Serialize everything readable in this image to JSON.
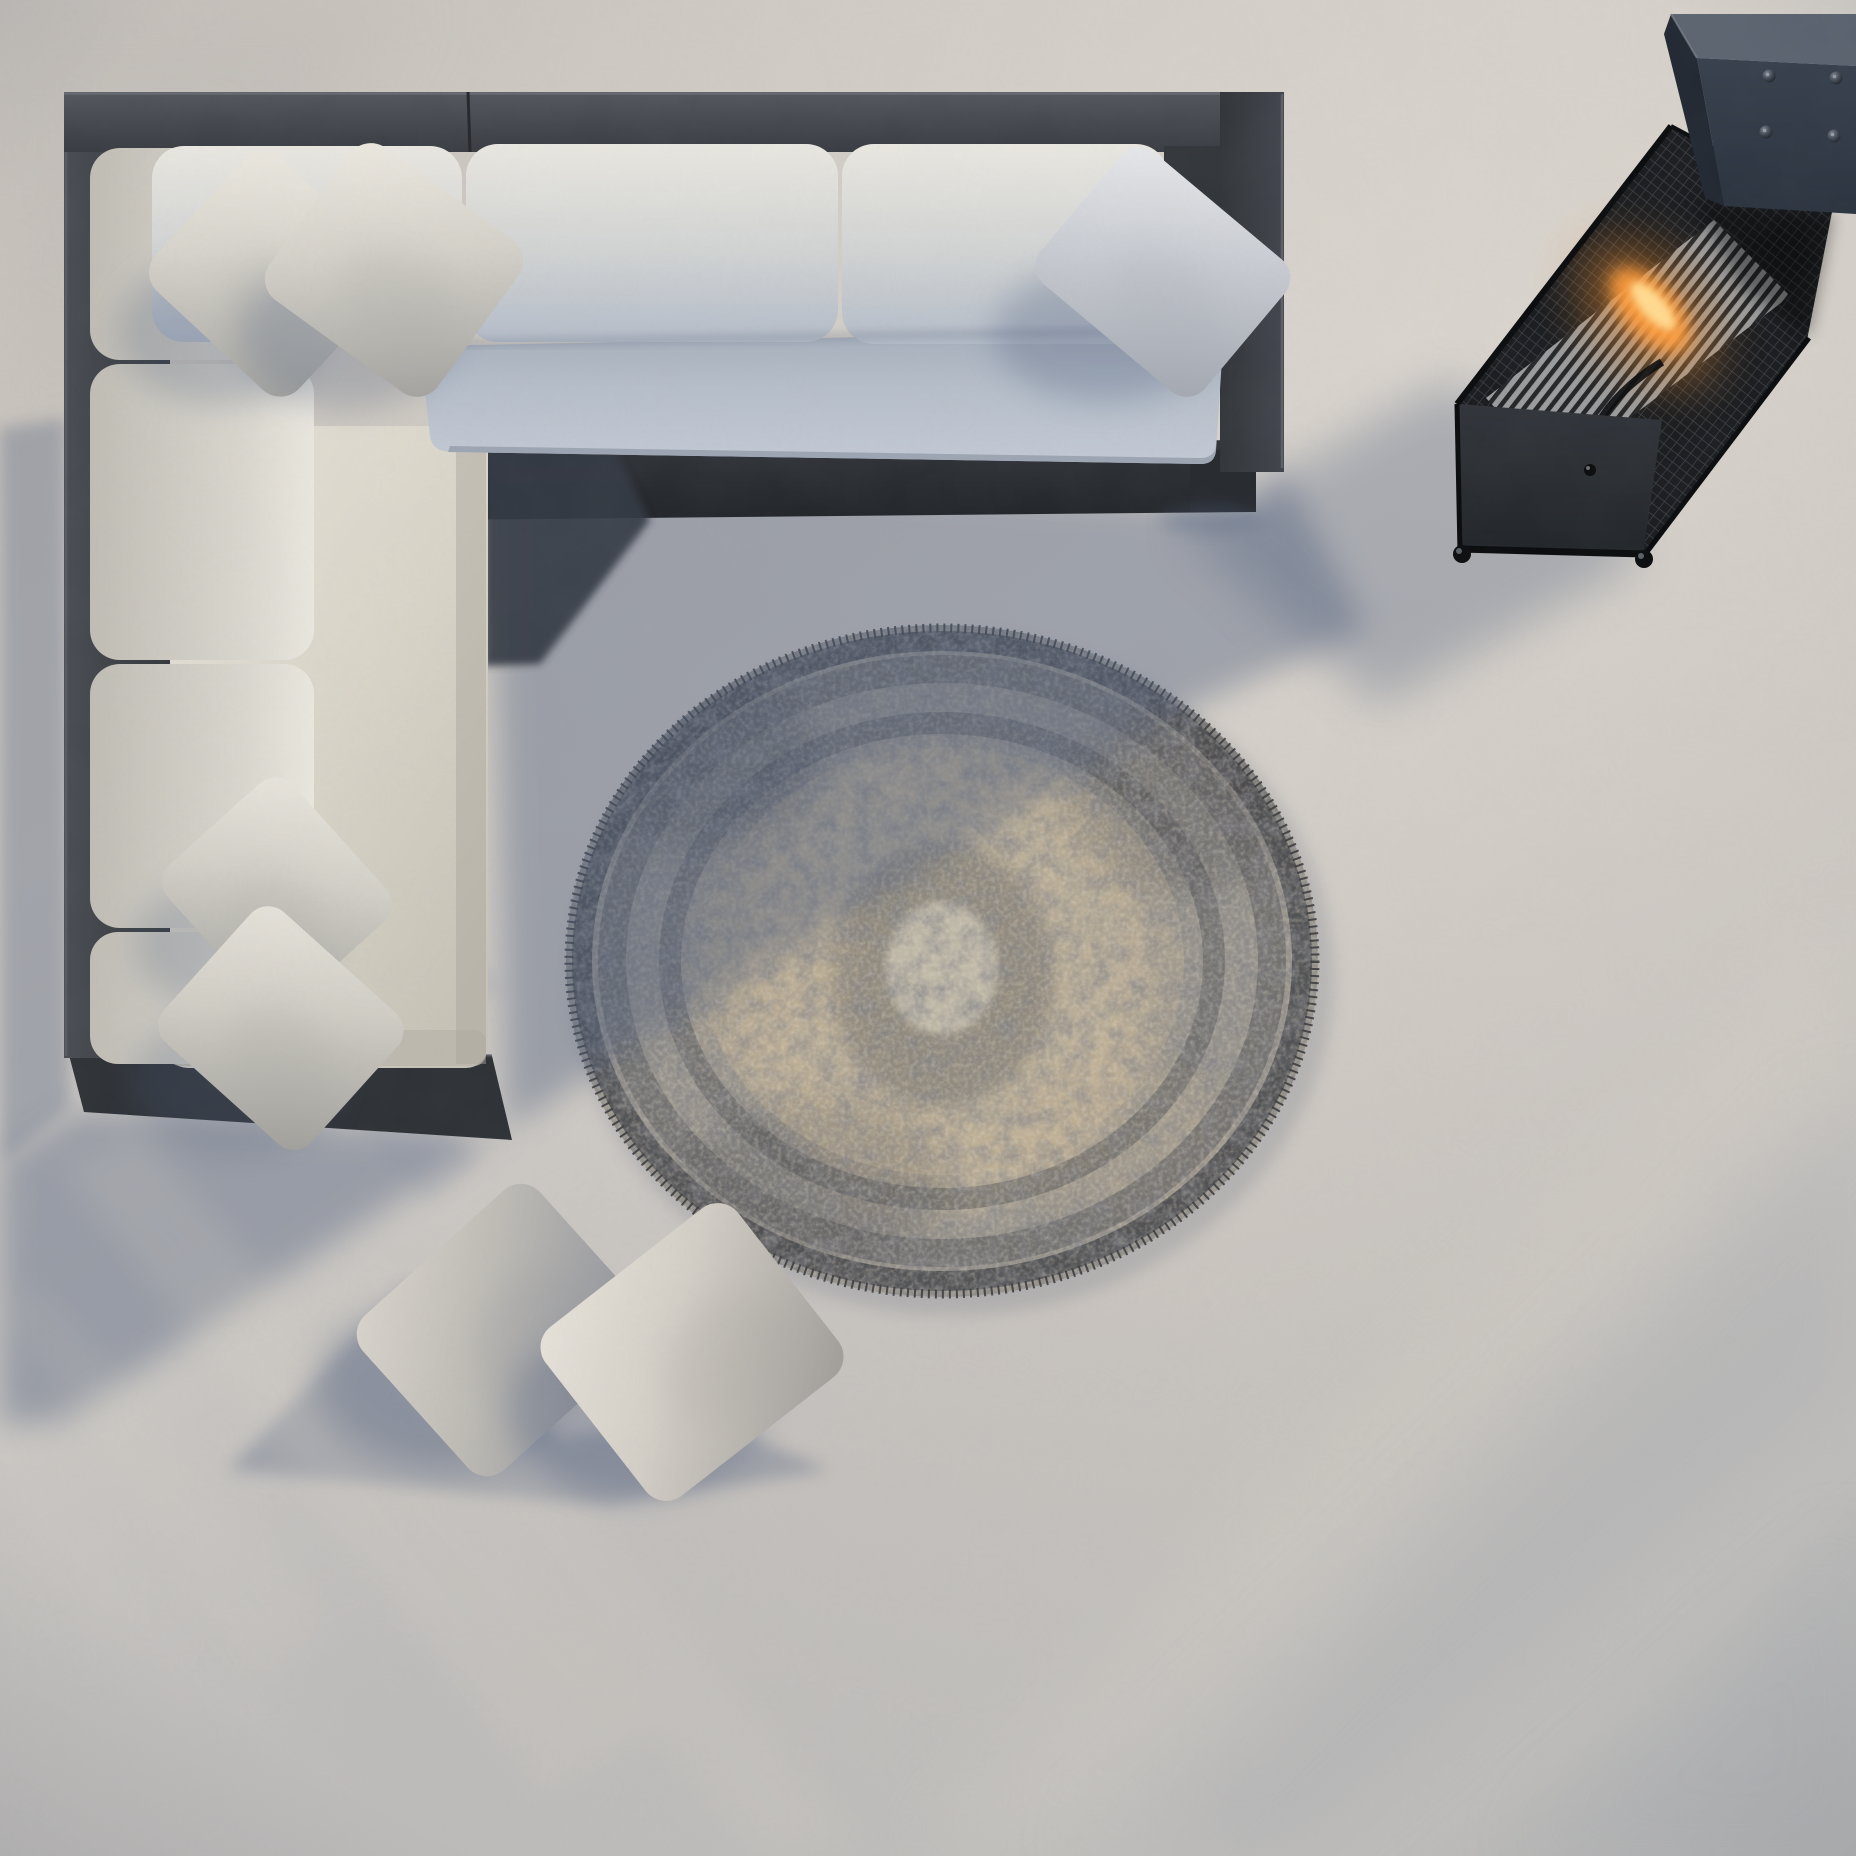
{
  "meta": {
    "description": "Top-down photorealistic render of an outdoor patio: charcoal aluminium L-shaped sectional sofa with light cushions and throw pillows, a round distressed vintage medallion rug, two pillows on the concrete floor, and a tall gas patio heater with visible flame at top right. Long soft shadows fall toward the lower left.",
    "view": "top-down",
    "image_type": "3d-render"
  },
  "lighting": {
    "sun_direction": "upper-right",
    "shadow_direction": "lower-left",
    "mood": "late afternoon sun on pale concrete"
  },
  "palette": {
    "floor_base": "#cdc8c1",
    "floor_warm": "#d7d2cb",
    "floor_top_left": "#c2beb8",
    "floor_cool": "#aeb2ba",
    "shadow_ink": "#4e5d7c",
    "frame_dark": "#3b3e44",
    "frame_darker": "#2a2d32",
    "frame_light": "#54575e",
    "frame_edge": "#6a6d73",
    "cushion_blue": "#b4bcc9",
    "cushion_blue_dark": "#a2aab8",
    "cushion_blue_light": "#c6cdd8",
    "cream_light": "#e8e5dc",
    "cream": "#d8d3c7",
    "cream_dark": "#c2beb2",
    "rug_base": "#908d88",
    "rug_dark": "#45464a",
    "rug_char": "#55565a",
    "rug_beige": "#c4b194",
    "rug_pale": "#cbc4b5",
    "heater_cap_top": "#5d6571",
    "heater_cap_front": "#333b48",
    "heater_cap_side": "#232a34",
    "heater_body": "#1b1d20",
    "heater_panel": "#2a2c2f",
    "mesh_line": "#51565c",
    "slat_base": "#a8a9aa",
    "slat_gap": "#26282b",
    "flame_glow": "#e98a2e",
    "flame_mid": "#ff9d3c",
    "flame_core": "#ffd98f"
  },
  "objects": [
    {
      "name": "sectional-sofa",
      "label": "charcoal L-shaped outdoor sectional with light grey cushions",
      "bbox": [
        64,
        92,
        1220,
        1050
      ]
    },
    {
      "name": "area-rug",
      "label": "round distressed grey/beige medallion outdoor rug",
      "bbox": [
        566,
        625,
        752,
        672
      ]
    },
    {
      "name": "patio-heater",
      "label": "black mesh gas patio heater with flame, seen from above",
      "bbox": [
        1457,
        14,
        399,
        548
      ]
    },
    {
      "name": "floor-pillows",
      "label": "two throw pillows lying on the concrete floor",
      "bbox": [
        386,
        1212,
        430,
        258
      ]
    }
  ],
  "rug": {
    "cx": 942,
    "cy": 961,
    "rx": 376,
    "ry": 336,
    "style": "distressed vintage medallion, charcoal field with beige centre"
  },
  "heater": {
    "bolt_count": 4,
    "bolts": [
      [
        1769,
        76
      ],
      [
        1836,
        78
      ],
      [
        1766,
        132
      ],
      [
        1834,
        136
      ]
    ],
    "flame_center": [
      1648,
      310
    ],
    "feet": [
      [
        1462,
        554
      ],
      [
        1644,
        559
      ]
    ]
  },
  "pillows": [
    {
      "name": "corner-throw-pillow-left",
      "cx": 272,
      "cy": 274,
      "w": 196,
      "h": 182,
      "rot": 43,
      "rc": 26,
      "light": "#ebe8e0",
      "mid": "#d6d3cb",
      "dark": "#a9a8a3",
      "sdx": -52,
      "sdy": 58,
      "sop": 0.26
    },
    {
      "name": "corner-throw-pillow-right",
      "cx": 394,
      "cy": 270,
      "w": 208,
      "h": 188,
      "rot": 36,
      "rc": 26,
      "light": "#ece9e1",
      "mid": "#d4d1c9",
      "dark": "#a5a4a0",
      "sdx": -48,
      "sdy": 64,
      "sop": 0.26
    },
    {
      "name": "arm-throw-pillow",
      "cx": 1163,
      "cy": 272,
      "w": 214,
      "h": 172,
      "rot": 40,
      "rc": 24,
      "light": "#e7e8ea",
      "mid": "#c9ccd2",
      "dark": "#a4a9b2",
      "sdx": -58,
      "sdy": 62,
      "sop": 0.28
    },
    {
      "name": "seat-throw-pillow-upper",
      "cx": 277,
      "cy": 893,
      "w": 186,
      "h": 168,
      "rot": 48,
      "rc": 24,
      "light": "#e8e5dd",
      "mid": "#d2cfc7",
      "dark": "#a6a5a0",
      "sdx": -46,
      "sdy": 52,
      "sop": 0.24
    },
    {
      "name": "seat-throw-pillow-lower",
      "cx": 281,
      "cy": 1028,
      "w": 198,
      "h": 176,
      "rot": 42,
      "rc": 24,
      "light": "#e6e3db",
      "mid": "#cfccc4",
      "dark": "#a2a19c",
      "sdx": -46,
      "sdy": 54,
      "sop": 0.24
    },
    {
      "name": "floor-pillow-left",
      "cx": 504,
      "cy": 1330,
      "w": 238,
      "h": 208,
      "rot": -42,
      "rc": 26,
      "light": "#d8d4cc",
      "mid": "#bdbab4",
      "dark": "#8f929a",
      "sdx": -64,
      "sdy": 54,
      "sop": 0.3
    },
    {
      "name": "floor-pillow-right",
      "cx": 692,
      "cy": 1352,
      "w": 244,
      "h": 214,
      "rot": -38,
      "rc": 26,
      "light": "#e6e2da",
      "mid": "#d2cec6",
      "dark": "#a39f9b",
      "sdx": -58,
      "sdy": 58,
      "sop": 0.3
    }
  ],
  "shadows": [
    {
      "name": "sofa-cast-shadow",
      "points": "0,1160 80,1110 506,1136 492,452 1248,508 1284,470 1366,628 1180,712 600,1068 62,1420 0,1425",
      "fill": "#4e5d7c",
      "opacity": 0.4,
      "blur": "b16"
    },
    {
      "name": "left-rail-shadow",
      "points": "0,428 66,418 70,1106 0,1162",
      "fill": "#4e5d7c",
      "opacity": 0.34,
      "blur": "b8"
    },
    {
      "name": "heater-cast-shadow",
      "points": "1452,378 1648,556 1378,706 1182,530",
      "fill": "#4e5d7c",
      "opacity": 0.33,
      "blur": "b24"
    },
    {
      "name": "floor-pillow-cast-shadow",
      "points": "408,1282 228,1470 608,1505 830,1470 700,1415 560,1438",
      "fill": "#4e5d7c",
      "opacity": 0.3,
      "blur": "b8"
    }
  ],
  "bands": [
    {
      "name": "streak-light-1",
      "points": "60,1165 140,1133 660,1722 545,1792",
      "fill": "#ddd6c8",
      "opacity": 0.16,
      "blur": "b16"
    },
    {
      "name": "streak-light-2",
      "points": "300,1296 380,1262 862,1846 758,1856",
      "fill": "#ddd6c8",
      "opacity": 0.13,
      "blur": "b16"
    },
    {
      "name": "streak-light-3",
      "points": "0,1302 42,1286 332,1622 252,1682",
      "fill": "#ddd6c8",
      "opacity": 0.1,
      "blur": "b16"
    },
    {
      "name": "cool-band-bottom-right",
      "points": "1060,1856 1856,1070 1856,1380 1290,1856",
      "fill": "#8b93a4",
      "opacity": 0.16,
      "blur": "b40"
    },
    {
      "name": "cool-band-corner",
      "points": "1500,1856 1856,1520 1856,1856",
      "fill": "#8b93a4",
      "opacity": 0.13,
      "blur": "b40"
    },
    {
      "name": "warm-band-bottom-right",
      "points": "900,1856 1856,900 1856,1118 1150,1856",
      "fill": "#e9e1d1",
      "opacity": 0.14,
      "blur": "b40"
    },
    {
      "name": "cool-corner-top-left",
      "points": "0,0 420,0 0,520",
      "fill": "#a9a7a6",
      "opacity": 0.18,
      "blur": "b40"
    },
    {
      "name": "cream-seat-streak-1",
      "points": "150,700 205,660 500,985 445,1030",
      "fill": "#7e889c",
      "opacity": 0.2,
      "blur": "b8"
    },
    {
      "name": "cream-seat-streak-2",
      "points": "148,902 200,866 478,1162 428,1202",
      "fill": "#7e889c",
      "opacity": 0.16,
      "blur": "b8"
    }
  ]
}
